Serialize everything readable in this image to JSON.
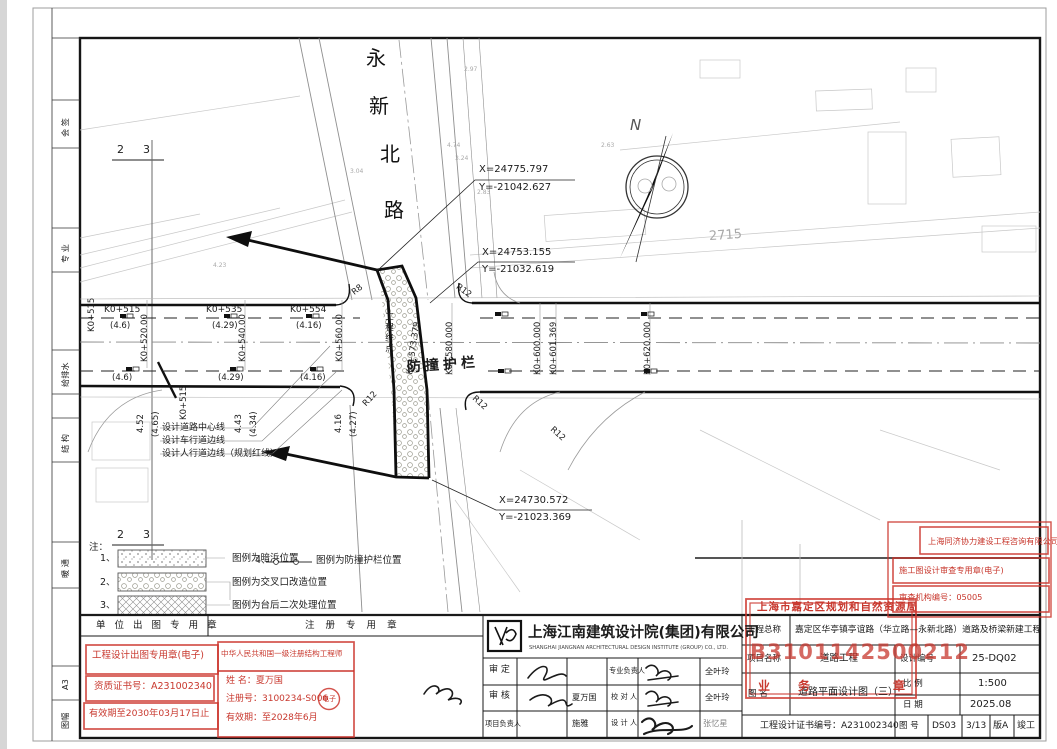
{
  "plan": {
    "road_name": [
      "永",
      "新",
      "北",
      "路"
    ],
    "coords": [
      {
        "x": "X=24775.797",
        "y": "Y=-21042.627"
      },
      {
        "x": "X=24753.155",
        "y": "Y=-21032.619"
      },
      {
        "x": "X=24730.572",
        "y": "Y=-21023.369"
      }
    ],
    "stations_top": [
      {
        "sta": "K0+515",
        "off": "(4.6)",
        "off2": "(4.6)"
      },
      {
        "sta": "K0+535",
        "off": "(4.29)",
        "off2": "(4.29)"
      },
      {
        "sta": "K0+554",
        "off": "(4.16)",
        "off2": "(4.16)"
      }
    ],
    "stations_rot": [
      "K0+520.00",
      "K0+540.00",
      "K0+560.00",
      "K0+580.000",
      "K0+600.000",
      "K0+601.369",
      "K0+620.000"
    ],
    "station_left": "K0+515",
    "station_left2": "K0+515",
    "edge_values": [
      "4.52",
      "(4.65)",
      "4.43",
      "(4.34)",
      "4.16",
      "(4.27)"
    ],
    "end_point_label": "工程终点",
    "end_station": "K0+573.379",
    "barrier_label": "防撞护栏",
    "radii": [
      "R8",
      "R12",
      "R12",
      "R12",
      "R12"
    ],
    "line_labels": [
      "设计道路中心线",
      "设计车行道边线",
      "设计人行道边线（规划红线）"
    ],
    "north_label": "N",
    "parcel_number": "2715",
    "section_marks": [
      "2",
      "3",
      "2",
      "3"
    ],
    "spots": [
      "2.97",
      "4.74",
      "3.24",
      "2.83",
      "3.04",
      "2.63",
      "4.23"
    ]
  },
  "legend": {
    "note": "注：",
    "items": [
      {
        "no": "1、",
        "label": "图例为暗浜位置"
      },
      {
        "no": "2、",
        "label": "图例为交叉口改造位置"
      },
      {
        "no": "3、",
        "label": "图例为台后二次处理位置"
      },
      {
        "no": "4、",
        "label": "图例为防撞护栏位置"
      }
    ]
  },
  "margin": {
    "labels": [
      "会 签",
      "专 业",
      "给排水",
      "结 构",
      "暖 通"
    ],
    "sheet_size": "A3",
    "sheet_label": "图幅"
  },
  "titleblock": {
    "headers": {
      "unit": "单 位 出 图 专 用 章",
      "reg": "注 册 专 用 章"
    },
    "design_stamp": {
      "l1": "工程设计出图专用章(电子)",
      "l2": "资质证书号：A231002340",
      "l3": "有效期至2030年03月17日止"
    },
    "engineer_stamp": {
      "title": "中华人民共和国一级注册结构工程师",
      "name": "姓  名：夏万国",
      "reg": "注册号：3100234-S006",
      "etag": "电子",
      "valid": "有效期：至2028年6月"
    },
    "company": {
      "cn": "上海江南建筑设计院(集团)有限公司",
      "en": "SHANGHAI JIANGNAN ARCHITECTURAL DESIGN INSTITUTE (GROUP) CO., LTD."
    },
    "approval": {
      "r1l": "审  定",
      "r2l": "审  核",
      "r3l": "项目负责人",
      "r1m": "",
      "r2m": "夏万国",
      "r3m": "施雅",
      "c1": "专业负责人",
      "c2": "校 对 人",
      "c3": "设 计 人",
      "n1": "全叶玲",
      "n2": "全叶玲",
      "n3": "张忆星"
    },
    "project": {
      "general_label": "工程总称",
      "general": "嘉定区华亭镇亭谊路（华立路—永新北路）道路及桥梁新建工程",
      "item_label": "项目名称",
      "item": "道路工程",
      "fig_label": "图    名",
      "fig": "道路平面设计图（三）",
      "cert": "工程设计证书编号：A231002340",
      "design_no_label": "设计编号",
      "design_no": "25-DQ02",
      "scale_label": "比    例",
      "scale": "1:500",
      "date_label": "日    期",
      "date": "2025.08",
      "no_label": "图    号",
      "no": "DS03",
      "sheet": "3/13",
      "rev": "版A",
      "phase": "竣工"
    },
    "review_stamp": {
      "company": "上海同济协力建设工程咨询有限公司",
      "l2": "施工图设计审查专用章(电子)",
      "l3": "审查机构编号：05005"
    },
    "gov_stamp": {
      "agency": "上海市嘉定区规划和自然资源局",
      "number": "B3101142500212",
      "seal_l": "业",
      "seal_m": "务",
      "seal_r": "章"
    }
  }
}
